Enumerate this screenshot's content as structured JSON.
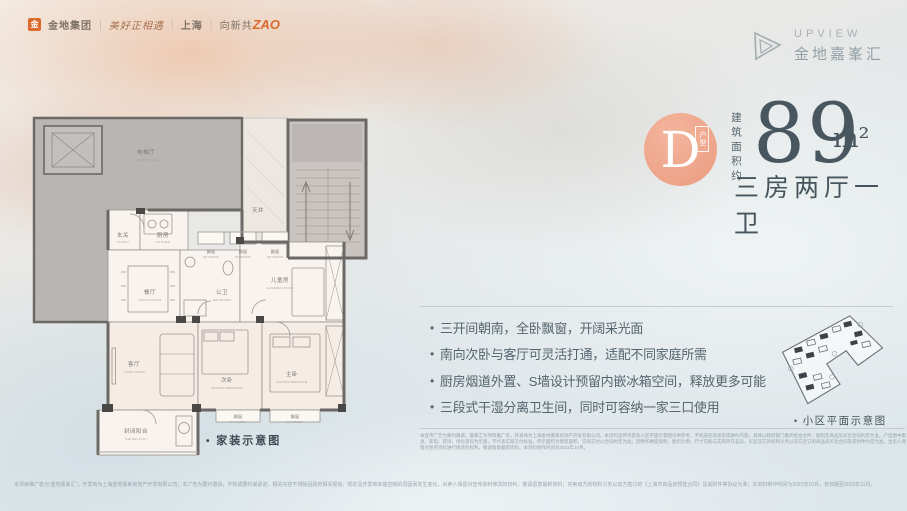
{
  "header": {
    "logo_bar": {
      "brand_icon": "金",
      "brand": "金地集团",
      "slogan": "美好正相遇",
      "city": "上海",
      "campaign_prefix": "向新共",
      "campaign_accent": "ZAO"
    },
    "brand_right": {
      "name_en": "UPVIEW",
      "name_cn": "金地嘉峯汇"
    }
  },
  "unit": {
    "badge_letter": "D",
    "badge_tag": "户型",
    "area_label": "建筑面积约",
    "area_value": "89",
    "area_unit": "m²",
    "layout": "三房两厅一卫"
  },
  "features": [
    "三开间朝南，全卧飘窗，开阔采光面",
    "南向次卧与客厅可灵活打通，适配不同家庭所需",
    "厨房烟道外置、S墙设计预留内嵌冰箱空间，释放更多可能",
    "三段式干湿分离卫生间，同时可容纳一家三口使用"
  ],
  "floorplan": {
    "caption": "家装示意图",
    "rooms": {
      "elevator_hall": {
        "cn": "电梯厅",
        "en": "ELEVATOR HALL"
      },
      "light_well": {
        "cn": "天井"
      },
      "porch": {
        "cn": "玄关",
        "en": "PORCH"
      },
      "kitchen": {
        "cn": "厨房",
        "en": "KITCHEN"
      },
      "dining": {
        "cn": "餐厅",
        "en": "DINING ROOM"
      },
      "bath": {
        "cn": "公卫",
        "en": "BATHROOM"
      },
      "kids": {
        "cn": "儿童房",
        "en": "CHILDREN ROOM"
      },
      "living": {
        "cn": "客厅",
        "en": "LIVING ROOM"
      },
      "second": {
        "cn": "次卧",
        "en": "SECOND BEDROOM"
      },
      "master": {
        "cn": "主卧",
        "en": "MASTER BEDROOM"
      },
      "balcony": {
        "cn": "封闭阳台",
        "en": "THE BALCONY"
      },
      "bay": {
        "cn": "飘窗",
        "en": "BAY WINDOW"
      }
    }
  },
  "siteplan": {
    "caption": "小区平面示意图"
  },
  "disclaimers": {
    "right_block": "本宣传广告为要约邀请，嘉峯汇为项目推广名，开发商为上海金地嘉峯房地产开发有限公司。本资料宣传内容及小区平面示意图仅供参考，不构成任何承诺或要约内容，具体以政府部门最终批准文件、图则及商品房买卖合同约定为准。户型图中家具、家电、装饰、绿化等仅为示意，不代表实际交付标准，所示面积为建筑面积，实际交付以合同约定为准；因制作精度限制，图示比例、尺寸可能与实际存在差异。买卖双方的权利义务以双方签订的商品房买卖合同及其附件约定为准，出卖人保留对宣传资料进行修改的权利，敬请留意最新资料。本资料制作时间为2022年10月。",
    "bottom_line": "本项目推广名为“金地嘉峯汇”，开发商为上海金地嘉峯房地产开发有限公司；本广告为要约邀请，不构成要约或承诺，相关内容不排除因政府相关规划、规定及开发商未能控制的原因而发生变化，出卖人保留对宣传资料修改的权利，敬请留意最新资料；买卖双方的权利义务以双方签订的《上海市商品房预售合同》及其附件等协议为准；本资料制作时间为2022年10月，有效期至2022年11月。"
  },
  "colors": {
    "accent": "#eb9c80",
    "headline": "#48565f",
    "wall": "#6b6866"
  }
}
